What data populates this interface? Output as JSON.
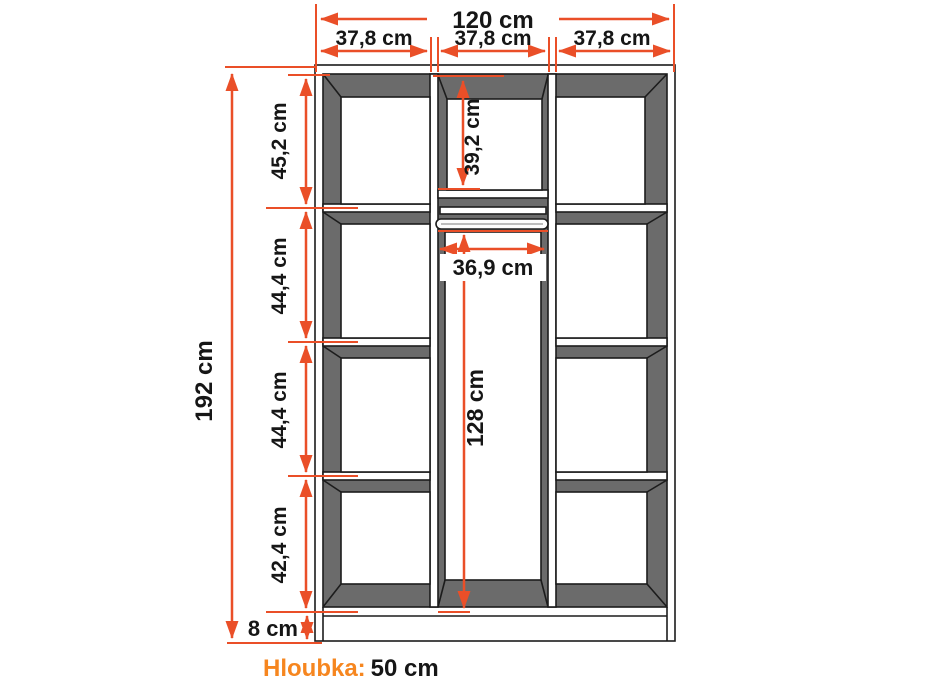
{
  "colors": {
    "dimension_orange": "#ea4f28",
    "depth_label_orange": "#f6861f",
    "cabinet_interior_gray": "#6b6b6b",
    "outline_black": "#1c1c1c",
    "text_black": "#161616",
    "background": "#ffffff"
  },
  "dimensions": {
    "total_width": "120 cm",
    "section_widths": [
      "37,8 cm",
      "37,8 cm",
      "37,8 cm"
    ],
    "total_height": "192 cm",
    "left_sections": [
      "45,2 cm",
      "44,4 cm",
      "44,4 cm",
      "42,4 cm"
    ],
    "plinth_height": "8 cm",
    "middle_top_height": "39,2 cm",
    "rod_width": "36,9 cm",
    "hanging_height": "128 cm"
  },
  "footer": {
    "depth_label": "Hloubka:",
    "depth_value": "50 cm"
  }
}
